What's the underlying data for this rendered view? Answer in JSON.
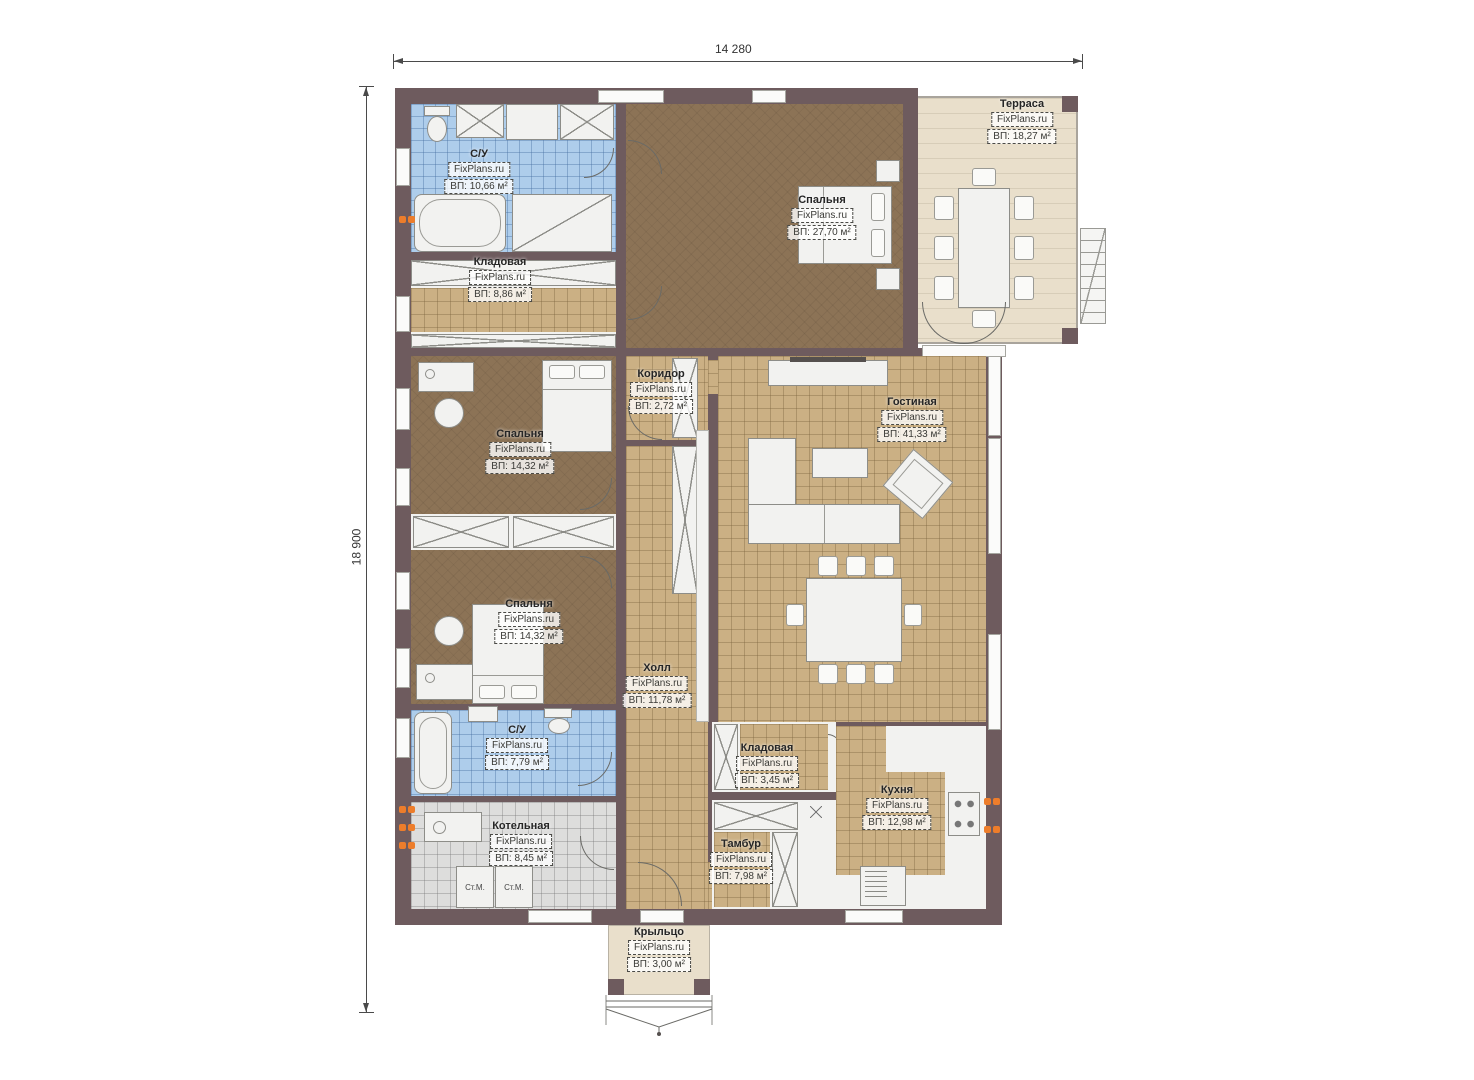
{
  "plan": {
    "dimensions": {
      "width_label": "14 280",
      "height_label": "18 900"
    },
    "brand": "FixPlans.ru",
    "washer_label": "Ст.М.",
    "rooms": [
      {
        "name": "С/У",
        "watermark": "FixPlans.ru",
        "area": "ВП: 10,66 м²"
      },
      {
        "name": "Кладовая",
        "watermark": "FixPlans.ru",
        "area": "ВП: 8,86 м²"
      },
      {
        "name": "Спальня",
        "watermark": "FixPlans.ru",
        "area": "ВП: 27,70 м²"
      },
      {
        "name": "Терраса",
        "watermark": "FixPlans.ru",
        "area": "ВП: 18,27 м²"
      },
      {
        "name": "Коридор",
        "watermark": "FixPlans.ru",
        "area": "ВП: 2,72 м²"
      },
      {
        "name": "Спальня",
        "watermark": "FixPlans.ru",
        "area": "ВП: 14,32 м²"
      },
      {
        "name": "Гостиная",
        "watermark": "FixPlans.ru",
        "area": "ВП: 41,33 м²"
      },
      {
        "name": "Спальня",
        "watermark": "FixPlans.ru",
        "area": "ВП: 14,32 м²"
      },
      {
        "name": "Холл",
        "watermark": "FixPlans.ru",
        "area": "ВП: 11,78 м²"
      },
      {
        "name": "С/У",
        "watermark": "FixPlans.ru",
        "area": "ВП: 7,79 м²"
      },
      {
        "name": "Кладовая",
        "watermark": "FixPlans.ru",
        "area": "ВП: 3,45 м²"
      },
      {
        "name": "Кухня",
        "watermark": "FixPlans.ru",
        "area": "ВП: 12,98 м²"
      },
      {
        "name": "Тамбур",
        "watermark": "FixPlans.ru",
        "area": "ВП: 7,98 м²"
      },
      {
        "name": "Котельная",
        "watermark": "FixPlans.ru",
        "area": "ВП: 8,45 м²"
      },
      {
        "name": "Крыльцо",
        "watermark": "FixPlans.ru",
        "area": "ВП: 3,00 м²"
      }
    ],
    "colors": {
      "wall": "#6e5b5e",
      "floor_tan": "#cbb084",
      "floor_brown": "#8c7356",
      "floor_blue": "#aecdeb",
      "floor_gray": "#dddddc",
      "terrace": "#e9dfcb",
      "radiator": "#ed7d2b"
    }
  }
}
